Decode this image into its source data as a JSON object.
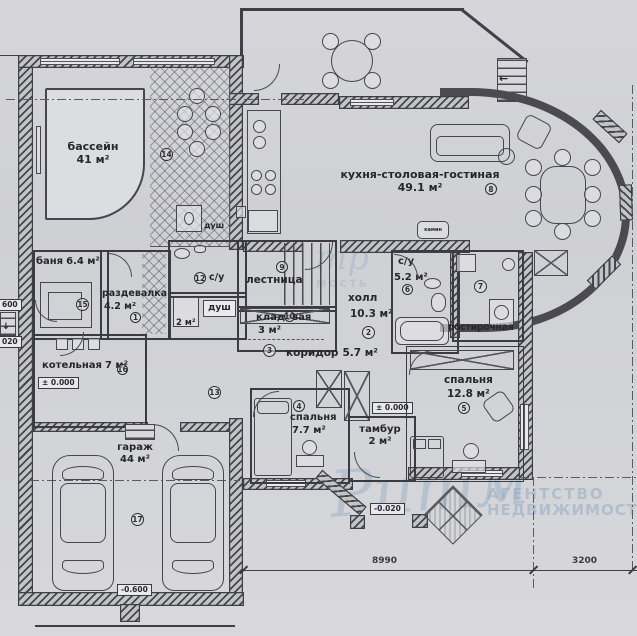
{
  "doc": {
    "type": "floor-plan",
    "units": "м²"
  },
  "colors": {
    "paper": "#d2d3d7",
    "ink": "#3a3a40",
    "watermark": "#8da8c2"
  },
  "rooms": {
    "pool": {
      "name": "бассейн",
      "area": "41 м²",
      "num": "14"
    },
    "banya": {
      "name": "баня",
      "area": "6.4 м²",
      "num": "15"
    },
    "razdevalka": {
      "name": "раздевалка",
      "area": "4.2 м²",
      "num": "1"
    },
    "kotelnaya": {
      "name": "котельная",
      "area": "7 м²",
      "num": "16"
    },
    "garage": {
      "name": "гараж",
      "area": "44 м²",
      "num": "17"
    },
    "su_pool": {
      "name": "с/у",
      "num": "12"
    },
    "dush_pool": {
      "name": "душ"
    },
    "dush2": {
      "name": "душ",
      "area": "2 м²"
    },
    "lestnitsa": {
      "name": "лестница",
      "num": "9"
    },
    "kladovaya": {
      "name": "кладовая",
      "area": "3 м²",
      "num": "10"
    },
    "koridor": {
      "name": "коридор",
      "area": "5.7 м²",
      "num": "3"
    },
    "hall": {
      "name": "холл",
      "area": "10.3 м²",
      "num": "2"
    },
    "su_big": {
      "name": "с/у",
      "area": "5.2 м²",
      "num": "6"
    },
    "postirochnaya": {
      "name": "постирочная",
      "num": "7"
    },
    "kitchen": {
      "name": "кухня-столовая-гостиная",
      "area": "49.1 м²",
      "num": "8"
    },
    "bedroom1": {
      "name": "спальня",
      "area": "7.7 м²",
      "num": "4"
    },
    "tambur": {
      "name": "тамбур",
      "area": "2 м²"
    },
    "bedroom2": {
      "name": "спальня",
      "area": "12.8 м²",
      "num": "5"
    },
    "hall13": {
      "num": "13"
    },
    "kamin": {
      "name": "камин"
    }
  },
  "elevations": {
    "zero_boiler": "± 0.000",
    "zero_tambur": "± 0.000",
    "garage": "-0.600",
    "porch": "-0.020",
    "left_top": "600",
    "left_bottom": "020"
  },
  "dimensions": {
    "d1": "8990",
    "d2": "3200"
  },
  "watermark": {
    "script": "Ритм",
    "line1": "АГЕНТСТВО",
    "line2": "НЕДВИЖИМОСТИ",
    "partial1": "тр",
    "partial2": "мость"
  }
}
